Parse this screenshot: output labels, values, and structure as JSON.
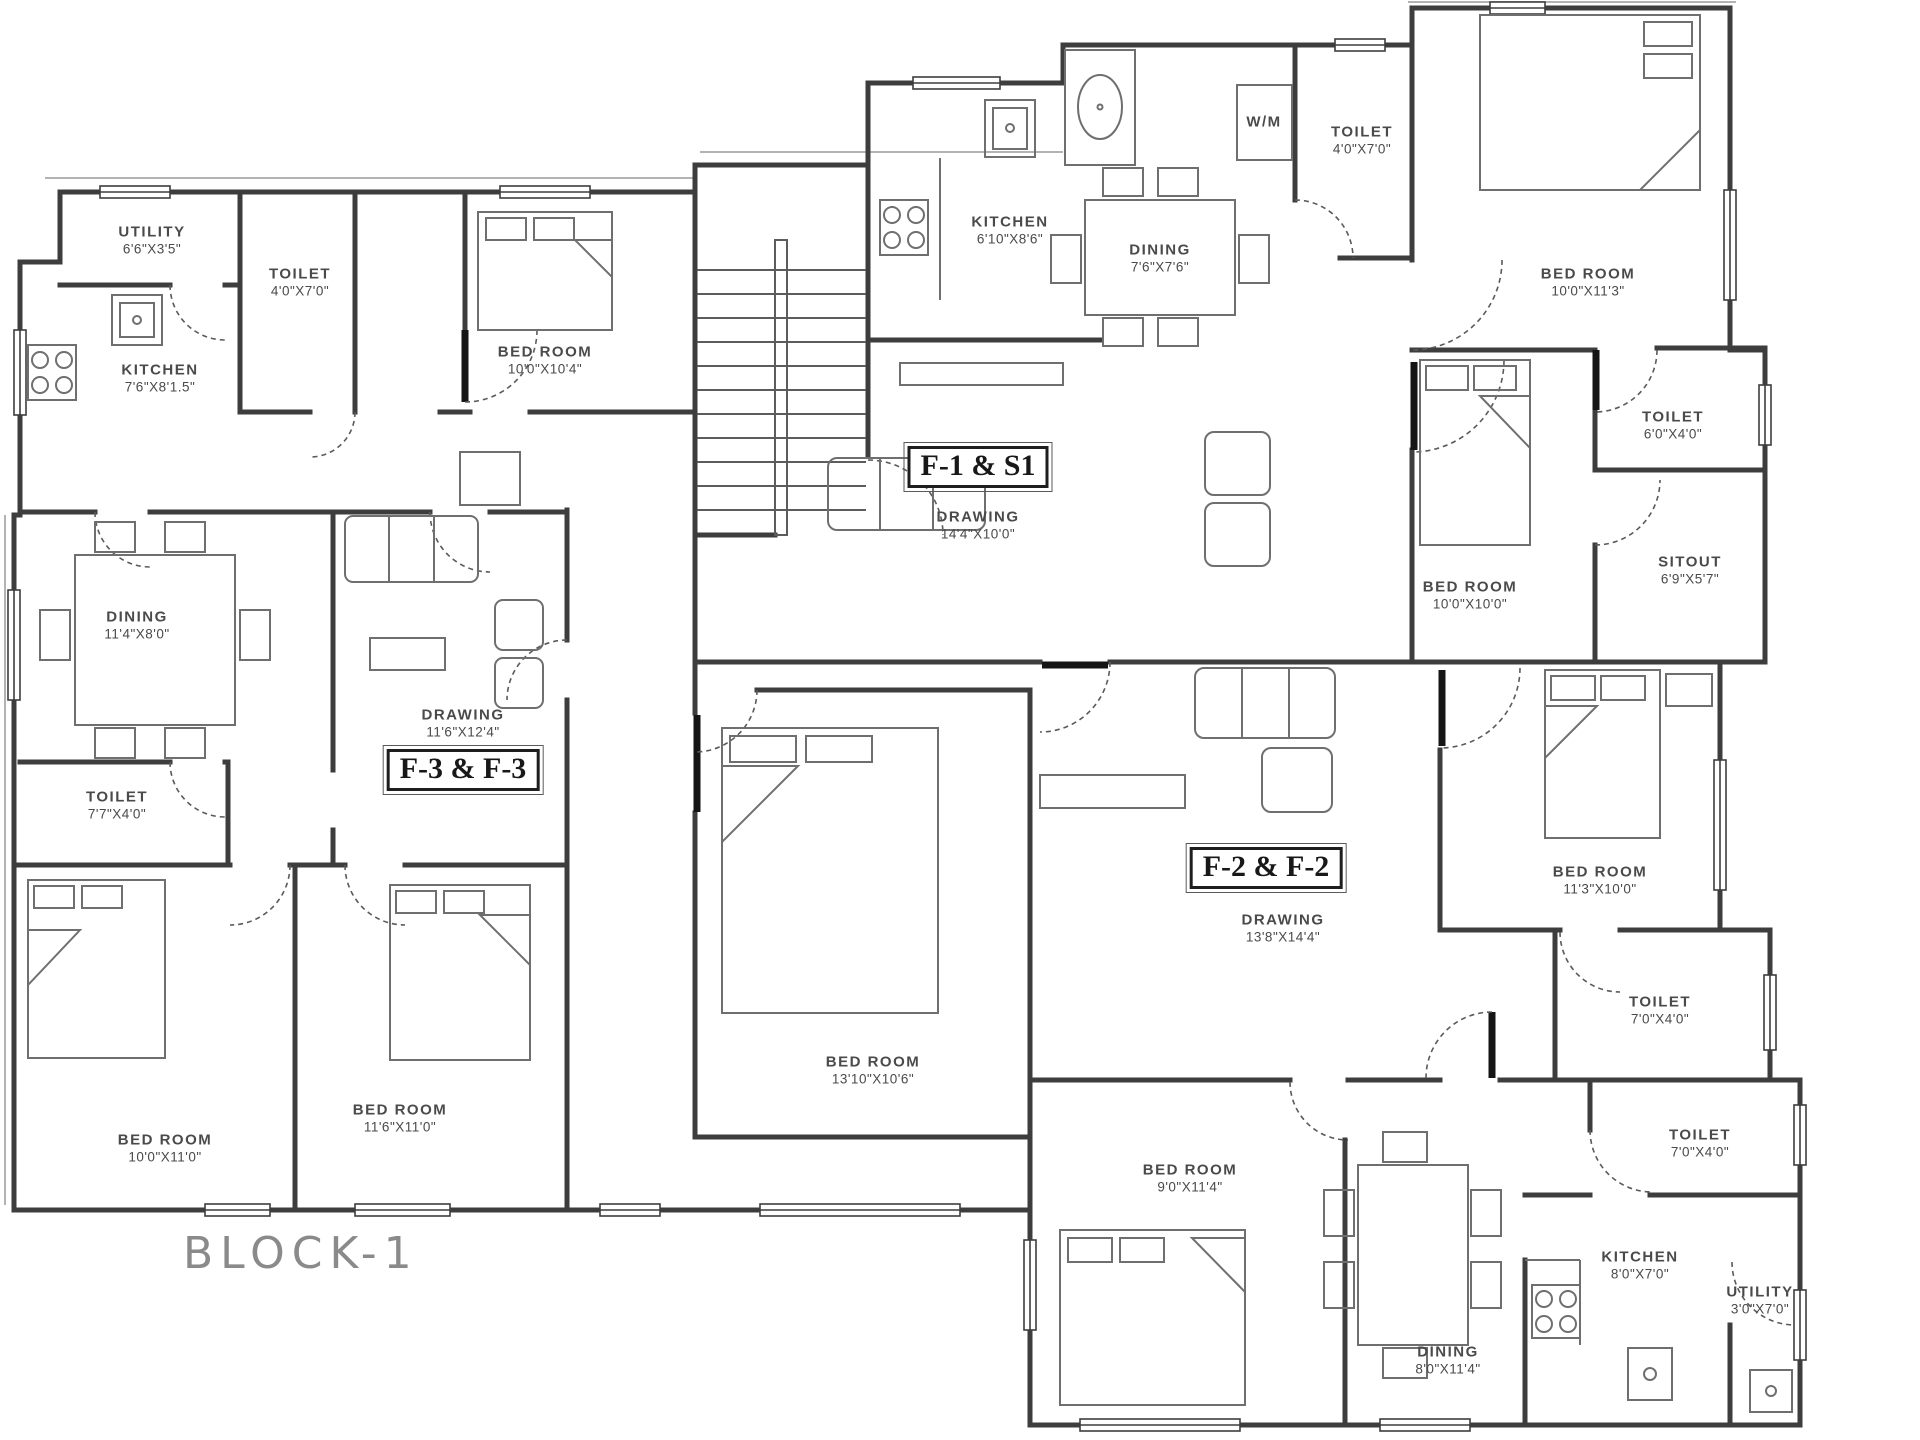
{
  "block_title": "BLOCK-1",
  "units": [
    {
      "label": "F-1 & S1"
    },
    {
      "label": "F-2 & F-2"
    },
    {
      "label": "F-3 & F-3"
    }
  ],
  "rooms": [
    {
      "name": "UTILITY",
      "dims": "6'6\"X3'5\""
    },
    {
      "name": "TOILET",
      "dims": "4'0\"X7'0\""
    },
    {
      "name": "KITCHEN",
      "dims": "7'6\"X8'1.5\""
    },
    {
      "name": "BED ROOM",
      "dims": "10'0\"X10'4\""
    },
    {
      "name": "DINING",
      "dims": "11'4\"X8'0\""
    },
    {
      "name": "DRAWING",
      "dims": "11'6\"X12'4\""
    },
    {
      "name": "TOILET",
      "dims": "7'7\"X4'0\""
    },
    {
      "name": "BED ROOM",
      "dims": "10'0\"X11'0\""
    },
    {
      "name": "BED ROOM",
      "dims": "11'6\"X11'0\""
    },
    {
      "name": "KITCHEN",
      "dims": "6'10\"X8'6\""
    },
    {
      "name": "DINING",
      "dims": "7'6\"X7'6\""
    },
    {
      "name": "W/M",
      "dims": ""
    },
    {
      "name": "TOILET",
      "dims": "4'0\"X7'0\""
    },
    {
      "name": "BED ROOM",
      "dims": "10'0\"X11'3\""
    },
    {
      "name": "DRAWING",
      "dims": "14'4\"X10'0\""
    },
    {
      "name": "TOILET",
      "dims": "6'0\"X4'0\""
    },
    {
      "name": "BED ROOM",
      "dims": "10'0\"X10'0\""
    },
    {
      "name": "SITOUT",
      "dims": "6'9\"X5'7\""
    },
    {
      "name": "BED ROOM",
      "dims": "13'10\"X10'6\""
    },
    {
      "name": "DRAWING",
      "dims": "13'8\"X14'4\""
    },
    {
      "name": "BED ROOM",
      "dims": "11'3\"X10'0\""
    },
    {
      "name": "TOILET",
      "dims": "7'0\"X4'0\""
    },
    {
      "name": "TOILET",
      "dims": "7'0\"X4'0\""
    },
    {
      "name": "BED ROOM",
      "dims": "9'0\"X11'4\""
    },
    {
      "name": "DINING",
      "dims": "8'0\"X11'4\""
    },
    {
      "name": "KITCHEN",
      "dims": "8'0\"X7'0\""
    },
    {
      "name": "UTILITY",
      "dims": "3'0\"X7'0\""
    }
  ],
  "colors": {
    "walls": "#3d3d3d",
    "furniture": "#6f6f6f",
    "doors": "#555555",
    "text": "#4a4a4a",
    "title": "#8a8a8a",
    "background": "#ffffff"
  }
}
